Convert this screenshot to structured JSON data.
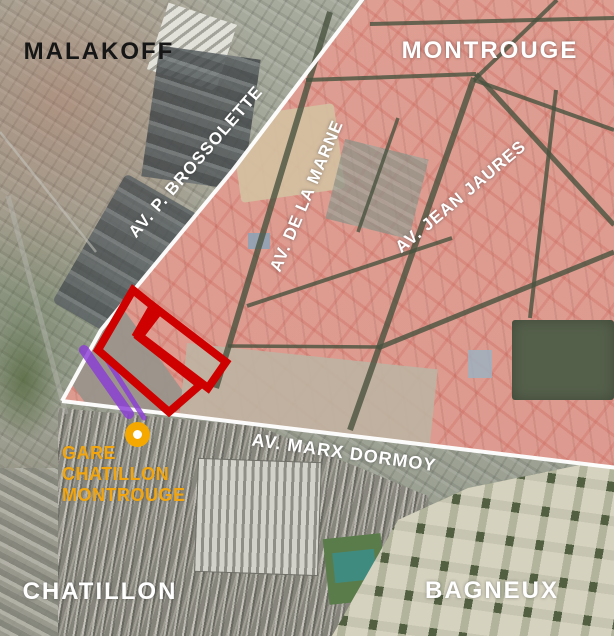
{
  "communes": {
    "malakoff": "MALAKOFF",
    "montrouge": "MONTROUGE",
    "chatillon": "CHATILLON",
    "bagneux": "BAGNEUX"
  },
  "avenues": {
    "brossolette": "AV. P. BROSSOLETTE",
    "marne": "AV. DE LA MARNE",
    "jaures": "AV. JEAN JAURES",
    "dormoy": "AV. MARX DORMOY"
  },
  "station": {
    "line1": "GARE",
    "line2": "CHATILLON",
    "line3": "MONTROUGE"
  },
  "colors": {
    "site_outline_red": "#CE0000",
    "rail_highlight_purple": "#8B3DD6",
    "station_accent_orange": "#F2A50C",
    "urban_overlay_pink": "#F3948A",
    "commune_boundary_white": "#FFFFFF"
  }
}
